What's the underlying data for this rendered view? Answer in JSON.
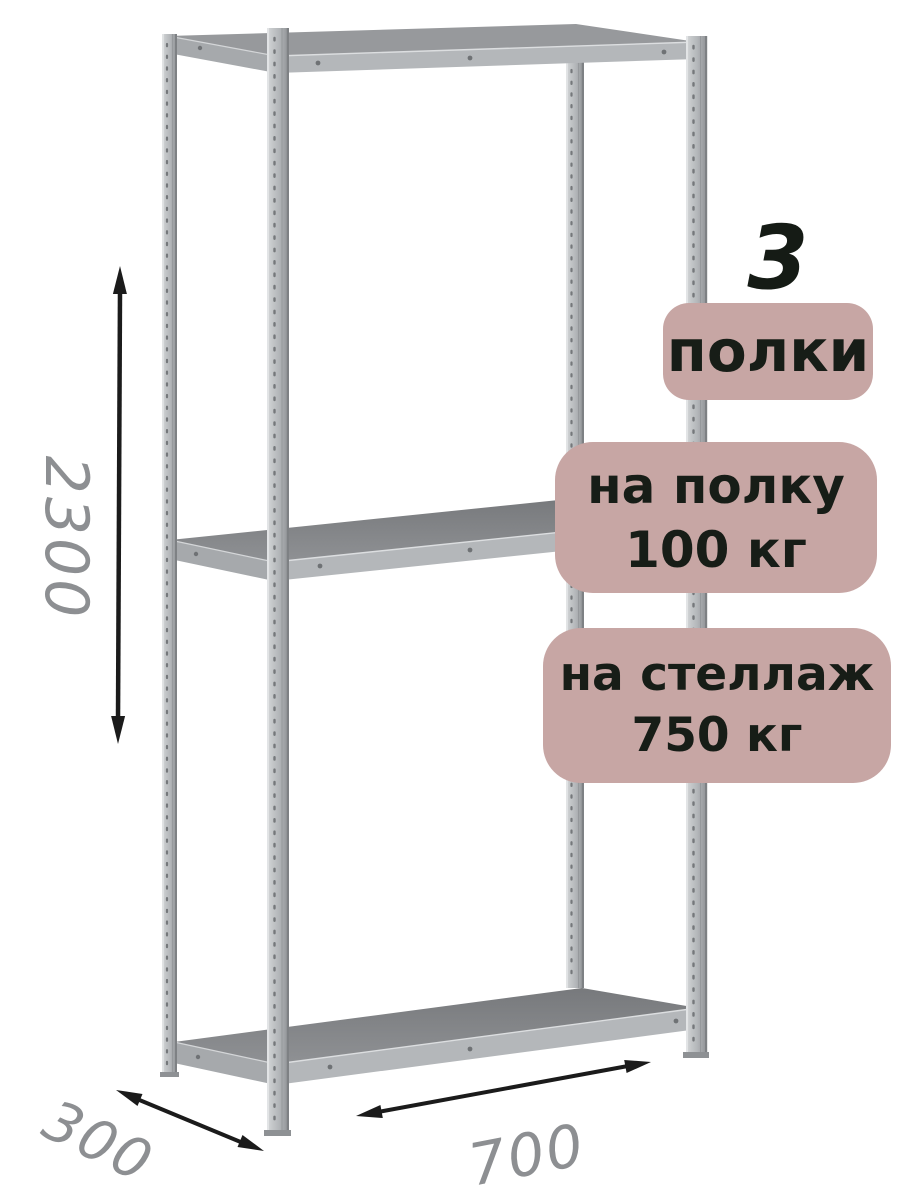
{
  "illustration": {
    "label": "metal-shelving-rack",
    "posts": [
      "back-left",
      "front-left",
      "back-right",
      "front-right"
    ],
    "shelf_positions": [
      "top",
      "middle",
      "bottom"
    ]
  },
  "badges": {
    "shelf_count_value": "3",
    "shelf_count_label": "полки",
    "shelf_load_line1": "на полку",
    "shelf_load_line2": "100 кг",
    "rack_load_line1": "на стеллаж",
    "rack_load_line2": "750 кг"
  },
  "dimensions": {
    "height_mm": "2300",
    "depth_mm": "300",
    "width_mm": "700"
  },
  "colors": {
    "background": "#ffffff",
    "badge_background": "#c7a6a4",
    "badge_text": "#171d17",
    "dimension_text": "#8d8f92",
    "arrow": "#1b1b1b",
    "metal_light": "#c9ccce",
    "metal_dark": "#8b8e91",
    "shelf_surface": "#85878a"
  }
}
